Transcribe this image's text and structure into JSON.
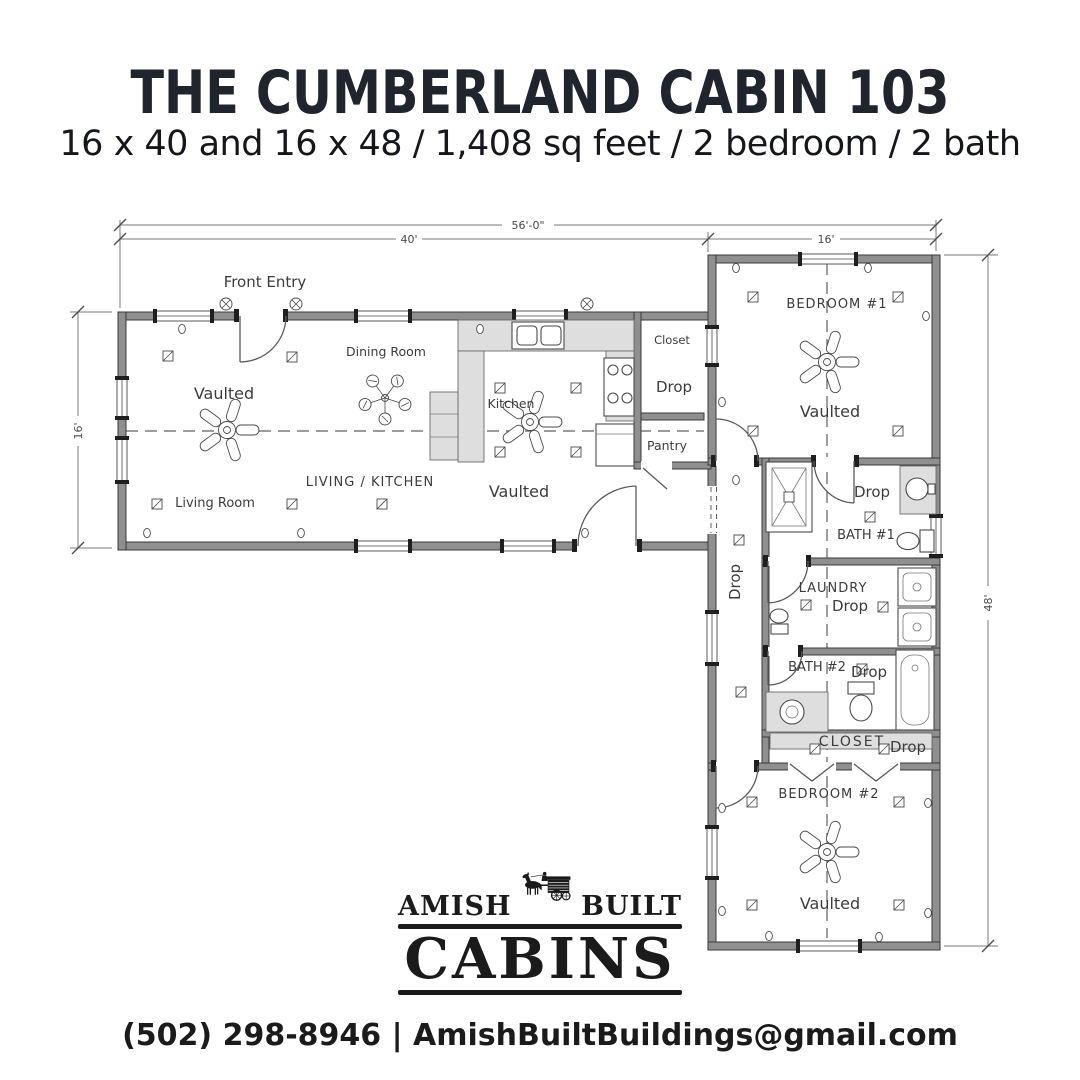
{
  "colors": {
    "ink": "#20242c",
    "plan_line": "#3a3a3a",
    "wall_fill": "#8f8f8f"
  },
  "header": {
    "title": "THE CUMBERLAND CABIN 103",
    "subtitle": "16 x 40 and 16 x 48 / 1,408 sq feet / 2 bedroom / 2 bath"
  },
  "floorplan": {
    "dims": {
      "overall": "56'-0\"",
      "left_width": "40'",
      "right_width": "16'",
      "left_depth": "16'",
      "right_depth": "48'"
    },
    "labels": {
      "front_entry": "Front Entry",
      "living_kitchen": "LIVING / KITCHEN",
      "living_room": "Living Room",
      "dining_room": "Dining Room",
      "kitchen": "Kitchen",
      "vaulted": "Vaulted",
      "closet_upper": "Closet",
      "pantry": "Pantry",
      "drop": "Drop",
      "bedroom1": "BEDROOM #1",
      "bath1": "BATH #1",
      "laundry": "LAUNDRY",
      "bath2": "BATH #2",
      "closet": "CLOSET",
      "bedroom2": "BEDROOM #2"
    }
  },
  "logo": {
    "word_left": "AMISH",
    "word_right": "BUILT",
    "word_main": "CABINS"
  },
  "footer": {
    "contact": "(502) 298-8946 | AmishBuiltBuildings@gmail.com"
  }
}
